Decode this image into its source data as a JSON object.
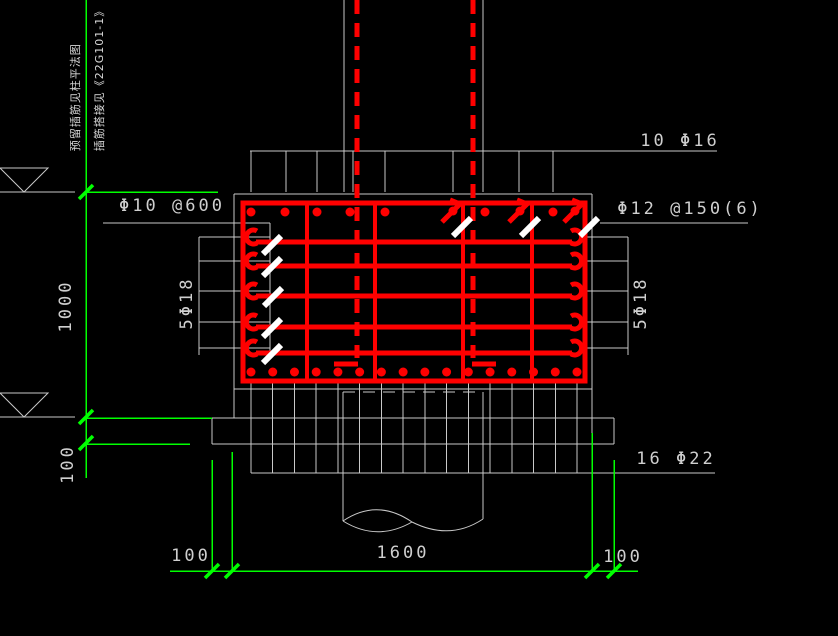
{
  "drawing": {
    "notes": {
      "line1": "预留插筋见柱平法图",
      "line2": "插筋搭接见《22G101-1》"
    },
    "rebar_labels": {
      "top_mesh": "10 Φ16",
      "stirrups": "Φ12 @150(6)",
      "ladder_bars": "Φ10 @600",
      "side_bars_left": "5Φ18",
      "side_bars_right": "5Φ18",
      "bottom_bars": "16 Φ22"
    },
    "dimensions": {
      "footing_height": "1000",
      "blinding_thickness": "100",
      "bottom_left_offset": "100",
      "footing_width": "1600",
      "bottom_right_offset": "100"
    },
    "colors": {
      "rebar": "#ff0000",
      "dimension_lines": "#00ff00",
      "concrete_lines": "#c9c9c9",
      "lap_marks": "#ffffff",
      "text": "#cfcfcf",
      "background": "#000000"
    }
  }
}
